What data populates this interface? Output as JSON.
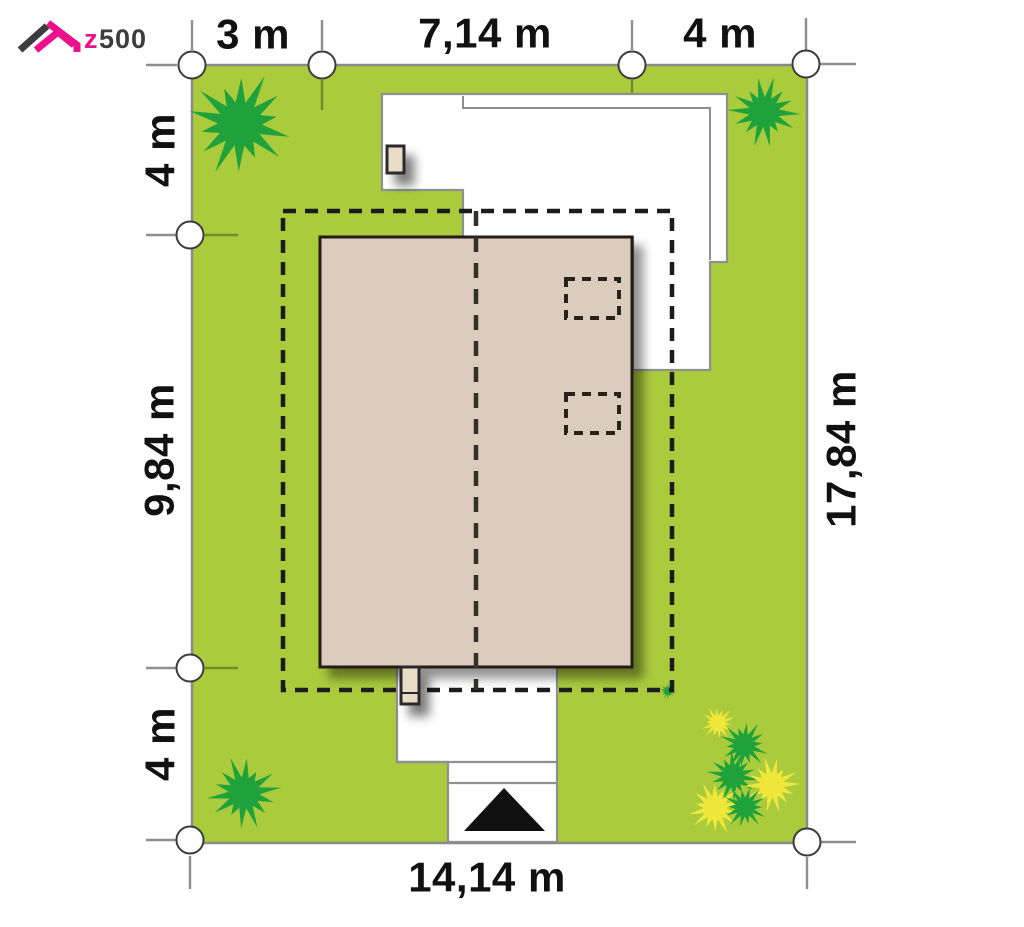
{
  "logo": {
    "brand_z": "z",
    "brand_number": "500"
  },
  "dimensions": {
    "top_left": "3 m",
    "top_mid": "7,14 m",
    "top_right": "4 m",
    "left_top": "4 m",
    "left_mid": "9,84 m",
    "left_bottom": "4 m",
    "right_full": "17,84 m",
    "bottom_full": "14,14 m"
  },
  "colors": {
    "lawn": "#a9cb3c",
    "lawn_border": "#8a8a8a",
    "outline_gray": "#8f8f8f",
    "white": "#ffffff",
    "roof_fill": "#dbccbe",
    "roof_border": "#261e14",
    "chimney_fill": "#e9dcc7",
    "dash_black": "#1c1c1c",
    "text": "#111111",
    "bush_green": "#1fa23b",
    "bush_yellow": "#efe73a",
    "logo_pink": "#ec108c",
    "logo_dark": "#3c3c3c"
  },
  "bushes": [
    {
      "x": 240,
      "y": 124,
      "r": 44,
      "color": "green",
      "seed": 1
    },
    {
      "x": 764,
      "y": 112,
      "r": 30,
      "color": "green",
      "seed": 2
    },
    {
      "x": 244,
      "y": 793,
      "r": 31,
      "color": "green",
      "seed": 3
    },
    {
      "x": 718,
      "y": 723,
      "r": 15,
      "color": "yellow",
      "seed": 4
    },
    {
      "x": 744,
      "y": 745,
      "r": 21,
      "color": "green",
      "seed": 5
    },
    {
      "x": 733,
      "y": 776,
      "r": 22,
      "color": "green",
      "seed": 6
    },
    {
      "x": 772,
      "y": 785,
      "r": 24,
      "color": "yellow",
      "seed": 7
    },
    {
      "x": 715,
      "y": 808,
      "r": 23,
      "color": "yellow",
      "seed": 8
    },
    {
      "x": 745,
      "y": 807,
      "r": 19,
      "color": "green",
      "seed": 9
    },
    {
      "x": 668,
      "y": 691,
      "r": 7,
      "color": "green",
      "seed": 10
    }
  ]
}
